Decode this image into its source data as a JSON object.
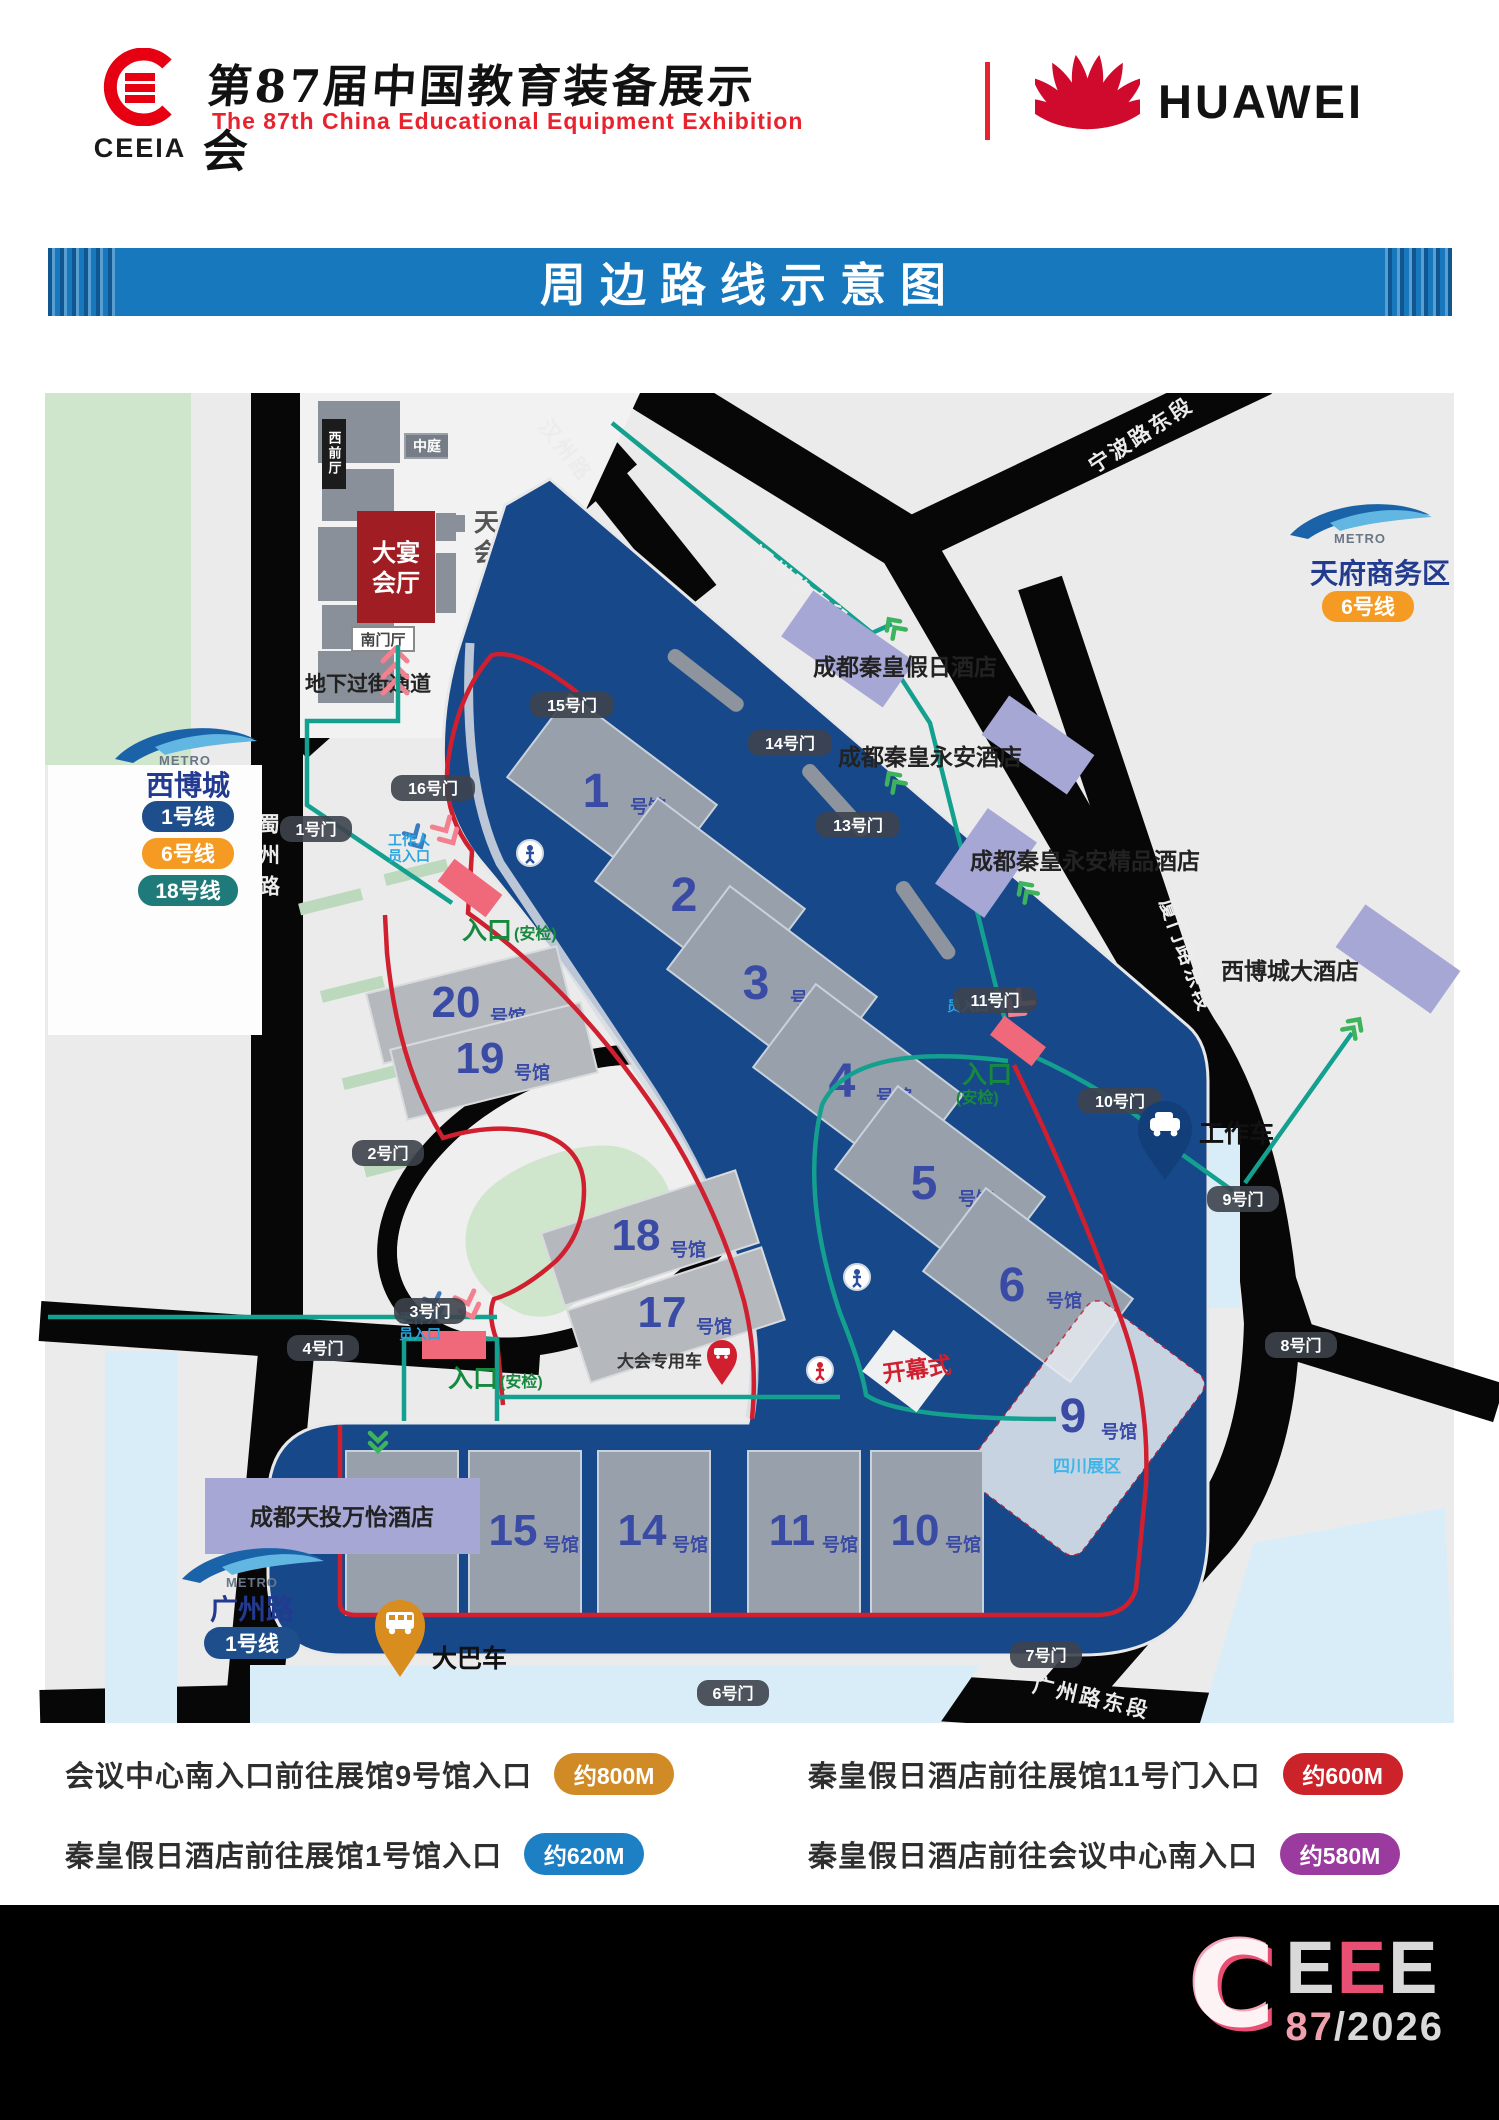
{
  "header": {
    "org_acronym": "CEEIA",
    "title_cn": "第87届中国教育装备展示会",
    "title_en": "The 87th China Educational Equipment Exhibition",
    "partner": "HUAWEI"
  },
  "banner": {
    "title": "周边路线示意图"
  },
  "map": {
    "metro": {
      "brand": "METRO",
      "brand_cn": "成都地铁"
    },
    "stations": [
      {
        "name": "西博城",
        "lines": [
          {
            "label": "1号线",
            "color": "#1f4e8c"
          },
          {
            "label": "6号线",
            "color": "#f59a23"
          },
          {
            "label": "18号线",
            "color": "#1f7a7a"
          }
        ]
      },
      {
        "name": "天府商务区",
        "lines": [
          {
            "label": "6号线",
            "color": "#f59a23"
          }
        ]
      },
      {
        "name": "广州路",
        "lines": [
          {
            "label": "1号线",
            "color": "#1f4e8c"
          }
        ]
      }
    ],
    "convention": {
      "west_hall": "西前厅",
      "atrium": "中庭",
      "banquet_l1": "大宴",
      "banquet_l2": "会厅",
      "south_hall": "南门厅",
      "name_l1": "天府国际",
      "name_l2": "会议中心",
      "underpass": "地下过街通道"
    },
    "roads": {
      "shuzhou": "蜀州路",
      "hanzhou": "汉州路",
      "fuzhou": "福州路东段",
      "ningbo": "宁波路东段",
      "xiamen": "厦门路东段",
      "guangzhou_e": "广州路东段"
    },
    "hotels": {
      "qinhuang_holiday": "成都秦皇假日酒店",
      "qinhuang_yongan": "成都秦皇永安酒店",
      "qinhuang_boutique": "成都秦皇永安精品酒店",
      "xibocheng_grand": "西博城大酒店",
      "tiantou_marriott": "成都天投万怡酒店"
    },
    "halls": [
      {
        "num": "1",
        "suffix": "号馆"
      },
      {
        "num": "2",
        "suffix": "号馆"
      },
      {
        "num": "3",
        "suffix": "号馆"
      },
      {
        "num": "4",
        "suffix": "号馆"
      },
      {
        "num": "5",
        "suffix": "号馆"
      },
      {
        "num": "6",
        "suffix": "号馆"
      },
      {
        "num": "9",
        "suffix": "号馆"
      },
      {
        "num": "10",
        "suffix": "号馆"
      },
      {
        "num": "11",
        "suffix": "号馆"
      },
      {
        "num": "14",
        "suffix": "号馆"
      },
      {
        "num": "15",
        "suffix": "号馆"
      },
      {
        "num": "16",
        "suffix": "号馆"
      },
      {
        "num": "17",
        "suffix": "号馆"
      },
      {
        "num": "18",
        "suffix": "号馆"
      },
      {
        "num": "19",
        "suffix": "号馆"
      },
      {
        "num": "20",
        "suffix": "号馆"
      }
    ],
    "gates": [
      "1号门",
      "2号门",
      "3号门",
      "4号门",
      "6号门",
      "7号门",
      "8号门",
      "9号门",
      "10号门",
      "11号门",
      "13号门",
      "14号门",
      "15号门",
      "16号门"
    ],
    "entrances": {
      "entry": "入口",
      "security": "(安检)",
      "staff_l1": "工作人",
      "staff_l2": "员入口"
    },
    "markers": {
      "work_car": "工作车",
      "bus": "大巴车",
      "vip_car": "大会专用车",
      "opening": "开幕式",
      "sichuan_zone": "四川展区"
    }
  },
  "legend": [
    {
      "text": "会议中心南入口前往展馆9号馆入口",
      "distance": "约800M",
      "color": "#d18b26"
    },
    {
      "text": "秦皇假日酒店前往展馆11号门入口",
      "distance": "约600M",
      "color": "#cc2229"
    },
    {
      "text": "秦皇假日酒店前往展馆1号馆入口",
      "distance": "约620M",
      "color": "#1d7fc4"
    },
    {
      "text": "秦皇假日酒店前往会议中心南入口",
      "distance": "约580M",
      "color": "#9b3ba0"
    }
  ],
  "footer": {
    "logo_c": "C",
    "logo_e1": "E",
    "logo_e2": "E",
    "logo_e3": "E",
    "edition": "87",
    "year": "/2026"
  }
}
